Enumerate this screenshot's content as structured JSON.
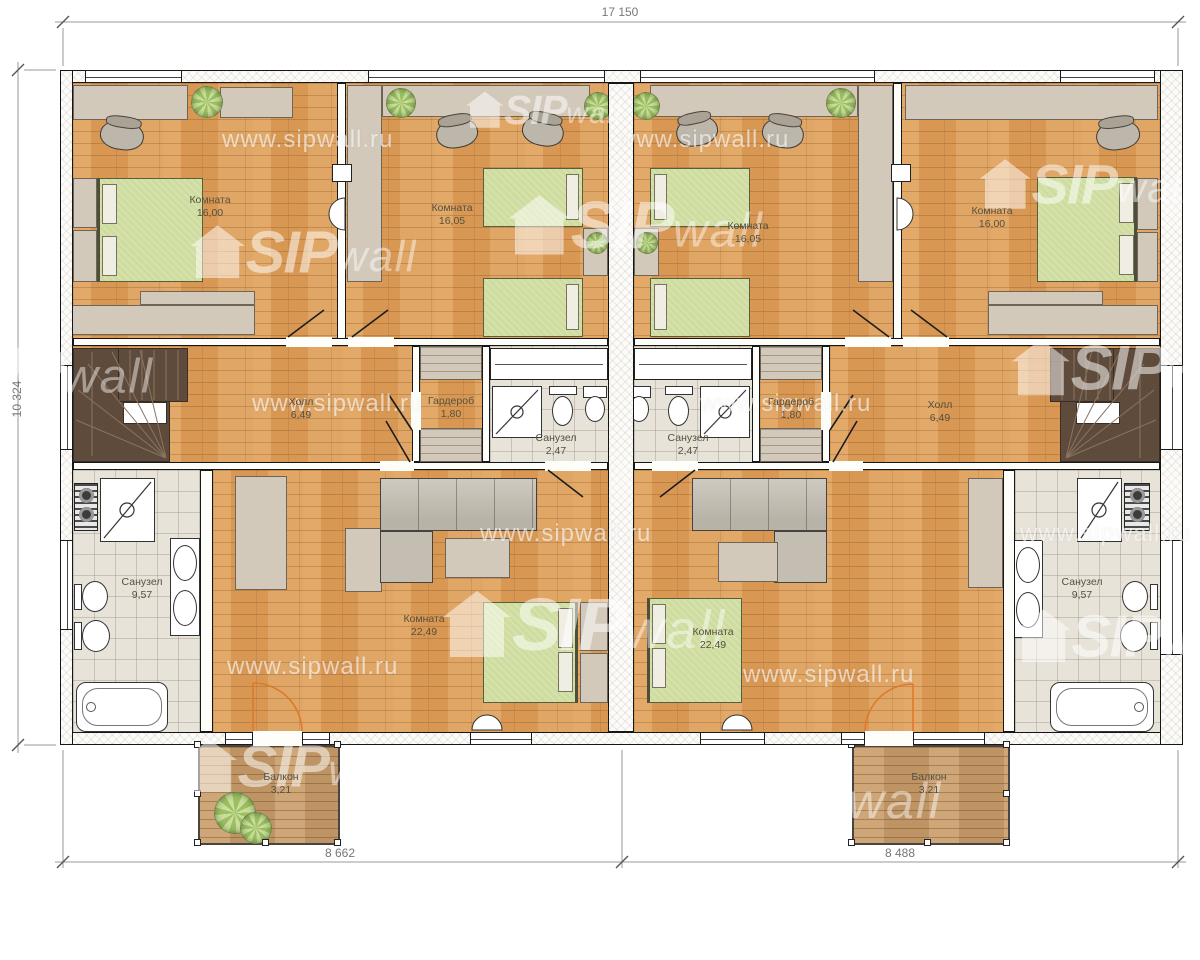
{
  "watermark": {
    "url": "www.sipwall.ru",
    "brand_bold": "SIP",
    "brand_light": "wall"
  },
  "dimensions": {
    "top": "17 150",
    "left": "10 324",
    "bottom_left": "8 662",
    "bottom_right": "8 488"
  },
  "rooms": [
    {
      "label": "Комната",
      "area": "16,00"
    },
    {
      "label": "Комната",
      "area": "16,05"
    },
    {
      "label": "Комната",
      "area": "16,05"
    },
    {
      "label": "Комната",
      "area": "16,00"
    },
    {
      "label": "Холл",
      "area": "6,49"
    },
    {
      "label": "Гардероб",
      "area": "1,80"
    },
    {
      "label": "Санузел",
      "area": "2,47"
    },
    {
      "label": "Санузел",
      "area": "2,47"
    },
    {
      "label": "Гардероб",
      "area": "1,80"
    },
    {
      "label": "Холл",
      "area": "6,49"
    },
    {
      "label": "Санузел",
      "area": "9,57"
    },
    {
      "label": "Комната",
      "area": "22,49"
    },
    {
      "label": "Комната",
      "area": "22,49"
    },
    {
      "label": "Санузел",
      "area": "9,57"
    },
    {
      "label": "Балкон",
      "area": "3,21"
    },
    {
      "label": "Балкон",
      "area": "3,21"
    }
  ]
}
